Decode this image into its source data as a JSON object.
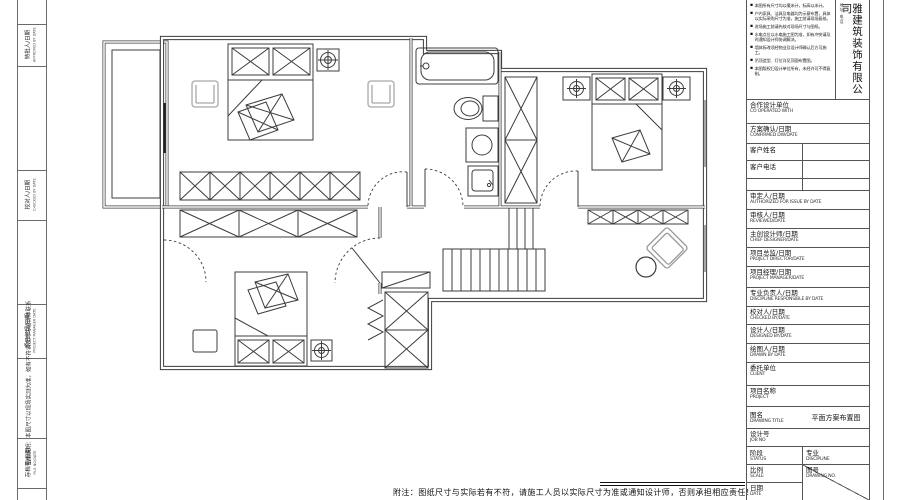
{
  "sheet": {
    "type": "residential floor plan drawing",
    "colors": {
      "line": "#3c3c3c",
      "light_line": "#a9a9a9",
      "frame": "#555555"
    }
  },
  "left_margin": {
    "labels": [
      {
        "cn": "特批人/日期",
        "en": "APPROVED BY DATE"
      },
      {
        "cn": "校对人/日期",
        "en": "CHECKED BY DATE"
      },
      {
        "cn": "项目经理/日期",
        "en": "PROJECT MANAGER DATE"
      },
      {
        "cn": "存档号/日期",
        "en": "FILE NO/DATE"
      }
    ],
    "annotation": "图纸说明：本图尺寸以现场实测为准，如有不符请及时与设计师联系"
  },
  "title_block": {
    "notes": [
      "本图所有尺寸均以毫米计，标高以米计。",
      "户内家具、洁具及电器均为示意布置，具体以实际采购尺寸为准，施工前请现场复核。",
      "进场施工前请先核对现场尺寸与图纸。",
      "水电点位以水电施工图为准，如有冲突请及时通知设计师协调解决。",
      "墙体拆改须经物业及设计师确认后方可施工。",
      "吊顶造型、灯位详见顶面布置图。",
      "本图版权归设计单位所有，未经许可不得复制。"
    ],
    "company": {
      "contact": "地址 电话",
      "name": "雅建筑装饰有限公司"
    },
    "rows": [
      {
        "cn": "合作设计单位",
        "en": "CO OPERATED WITH"
      },
      {
        "cn": "方案确认/日期",
        "en": "CONFIRMED DW/DATE"
      },
      {
        "cn": "审定人/日期",
        "en": "AUTHORIZED FOR ISSUE BY DATE"
      },
      {
        "cn": "审核人/日期",
        "en": "REVIEWED/DATE"
      },
      {
        "cn": "主创设计师/日期",
        "en": "CHIEF DESIGNER/DATE"
      },
      {
        "cn": "项目总监/日期",
        "en": "PROJECT DIRECTOR/DATE"
      },
      {
        "cn": "项目经理/日期",
        "en": "PROJECT MANAGER/DATE"
      },
      {
        "cn": "专业负责人/日期",
        "en": "DISCIPLINE RESPONSIBLE BY DATE"
      },
      {
        "cn": "校对人/日期",
        "en": "CHECKED BY/DATE"
      },
      {
        "cn": "设计人/日期",
        "en": "DESIGNED BY/DATE"
      },
      {
        "cn": "绘图人/日期",
        "en": "DRAWN BY DATE"
      },
      {
        "cn": "委托单位",
        "en": "CLIENT"
      },
      {
        "cn": "项目名称",
        "en": "PROJECT"
      }
    ],
    "client_name_label": "客户姓名",
    "client_phone_label": "客户电话",
    "drawing_title": {
      "cn": "图名",
      "en": "DRAWING TITLE",
      "value": "平面方案布置图"
    },
    "job_no": {
      "cn": "设计号",
      "en": "JOB  NO"
    },
    "status": {
      "cn": "阶段",
      "en": "STATUS"
    },
    "discipline": {
      "cn": "专业",
      "en": "DISCIPLINE"
    },
    "scale": {
      "cn": "比例",
      "en": "SCALE"
    },
    "date": {
      "cn": "日期",
      "en": "DATE"
    },
    "drawing_no": {
      "cn": "图号",
      "en": "DRAWING NO."
    }
  },
  "bottom_note": "附注：图纸尺寸与实际若有不符，请施工人员以实际尺寸为准或通知设计师，否则承担相应责任！"
}
